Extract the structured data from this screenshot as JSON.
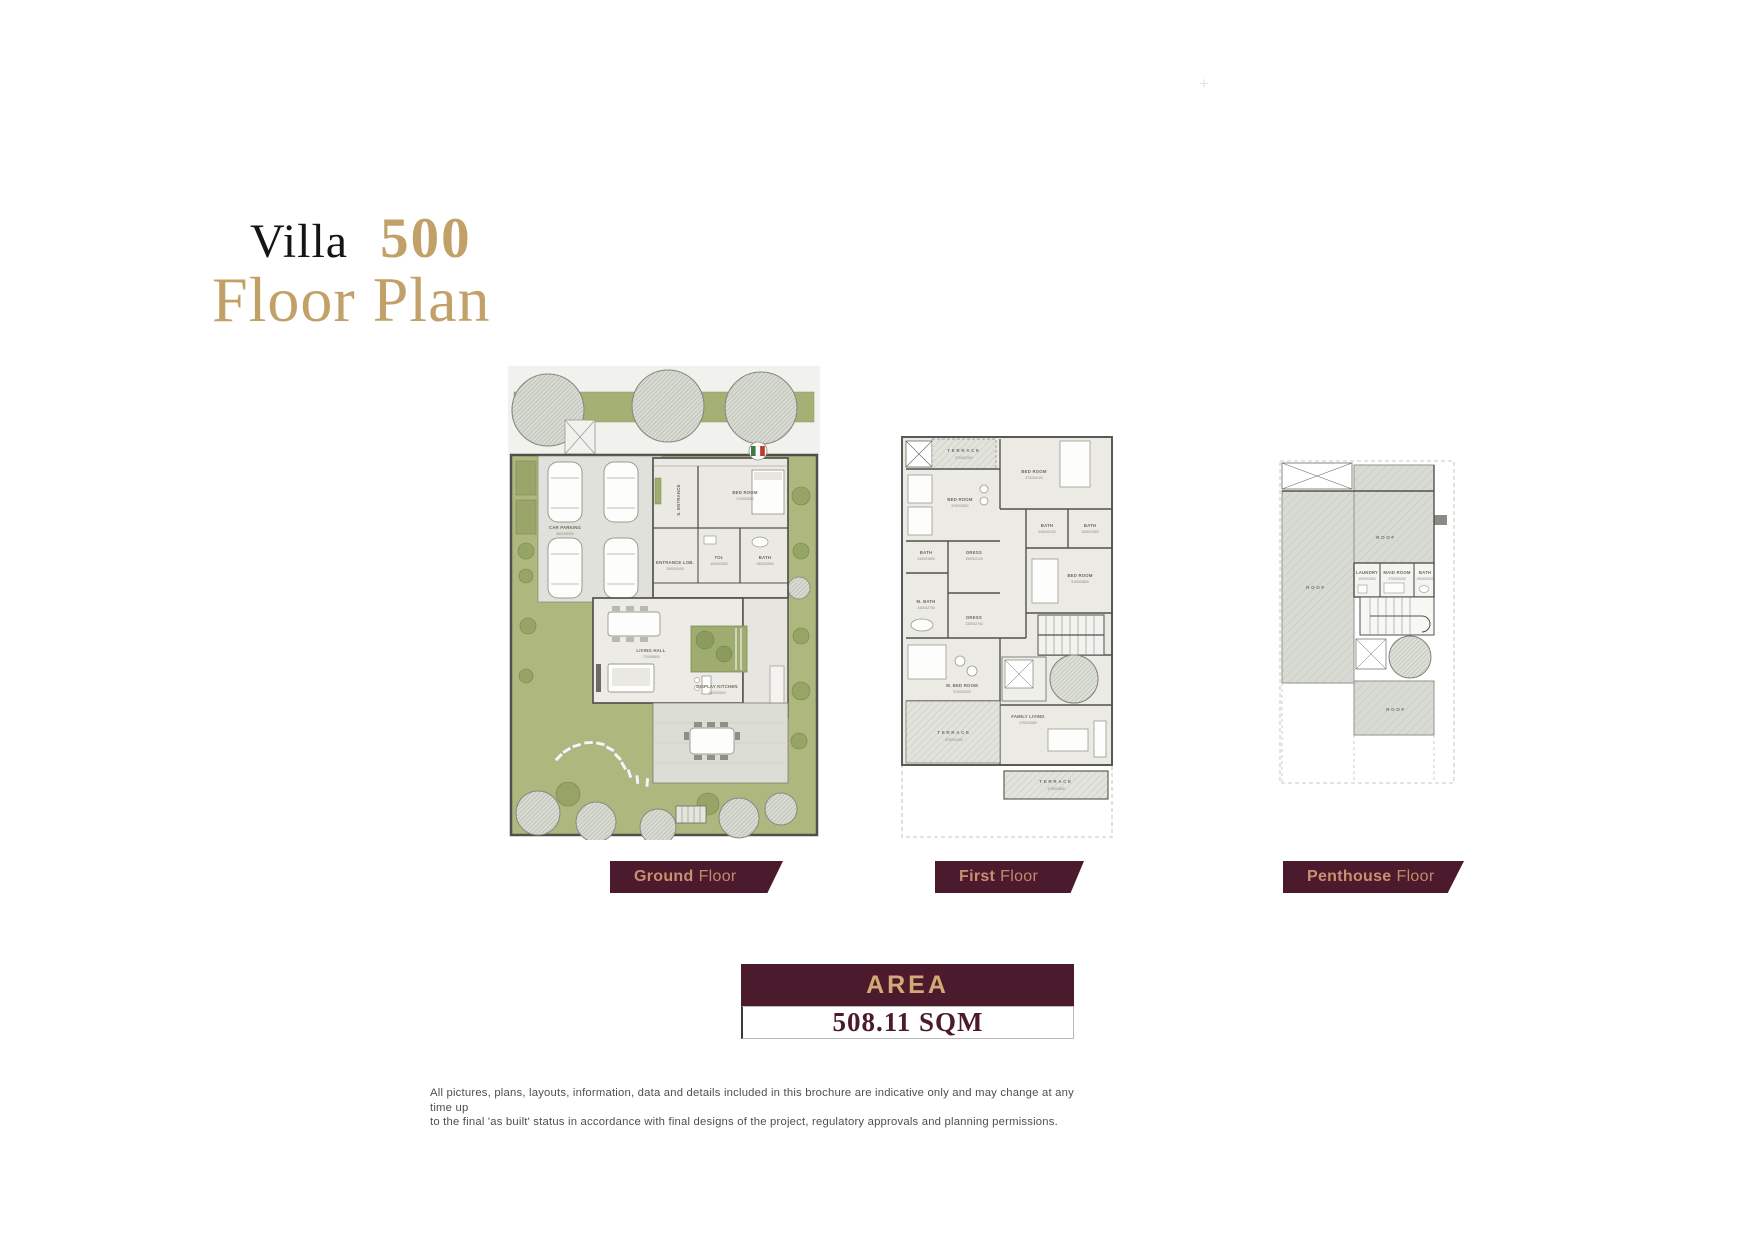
{
  "title": {
    "villa": "Villa",
    "number": "500",
    "subtitle": "Floor Plan"
  },
  "plus_mark": "+",
  "area": {
    "header": "AREA",
    "value": "508.11 SQM"
  },
  "disclaimer": {
    "line1": "All pictures, plans, layouts, information, data and details included in this brochure are indicative only and may change at any time up",
    "line2": "to the final 'as built' status in accordance with final designs of the project, regulatory approvals and planning permissions."
  },
  "colors": {
    "gold": "#C2A169",
    "maroon": "#4B1A2C",
    "ribbon_text": "#C9906F",
    "garden": "#AEB77D"
  },
  "floors": {
    "ground": {
      "label_bold": "Ground",
      "label_rest": "Floor",
      "rooms": {
        "car_parking": "CAR PARKING",
        "car_parking_dim": "5500X5000",
        "s_entrance": "S. ENTRANCE",
        "bed_room": "BED ROOM",
        "bed_room_dim": "4700X3600",
        "toi": "TOI.",
        "toi_dim": "1500X2500",
        "bath": "BATH",
        "bath_dim": "1800X2500",
        "entrance_lob": "ENTRANCE LOB.",
        "entrance_lob_dim": "3300X2400",
        "living_hall": "LIVING HALL",
        "living_hall_dim": "7700X5800",
        "display_kitchen": "DISPLAY KITCHEN",
        "display_kitchen_dim": "3500X3600",
        "kitchen": "KITCHEN",
        "kitchen_dim": "3300X3600"
      }
    },
    "first": {
      "label_bold": "First",
      "label_rest": "Floor",
      "rooms": {
        "terrace_top": "TERRACE",
        "terrace_top_dim": "3700X2300",
        "bed_room_top": "BED ROOM",
        "bed_room_top_dim": "4700X4100",
        "bed_room_left": "BED ROOM",
        "bed_room_left_dim": "5700X3800",
        "bath_left": "BATH",
        "bath_left_dim": "2400X1900",
        "dress_left": "DRESS",
        "dress_left_dim": "1900X2100",
        "m_bath": "M. BATH",
        "m_bath_dim": "2400X2700",
        "dress_mid": "DRESS",
        "dress_mid_dim": "2300X2700",
        "bath_mid": "BATH",
        "bath_mid_dim": "2400X2100",
        "bath_right": "BATH",
        "bath_right_dim": "2400X1900",
        "bed_room_right": "BED ROOM",
        "bed_room_right_dim": "5100X3800",
        "m_bed_room": "M. BED ROOM",
        "m_bed_room_dim": "5700X3200",
        "terrace_left": "TERRACE",
        "terrace_left_dim": "5700X2400",
        "family_living": "FAMILY LIVING",
        "family_living_dim": "4700X3600",
        "terrace_bottom": "TERRACE",
        "terrace_bottom_dim": "4700X1800"
      }
    },
    "penthouse": {
      "label_bold": "Penthouse",
      "label_rest": "Floor",
      "rooms": {
        "roof": "ROOF",
        "laundry": "LAUNDRY",
        "laundry_dim": "1900X2000",
        "maid_room": "MAID ROOM",
        "maid_room_dim": "3700X2200",
        "bath": "BATH",
        "bath_dim": "1900X2000"
      }
    }
  }
}
